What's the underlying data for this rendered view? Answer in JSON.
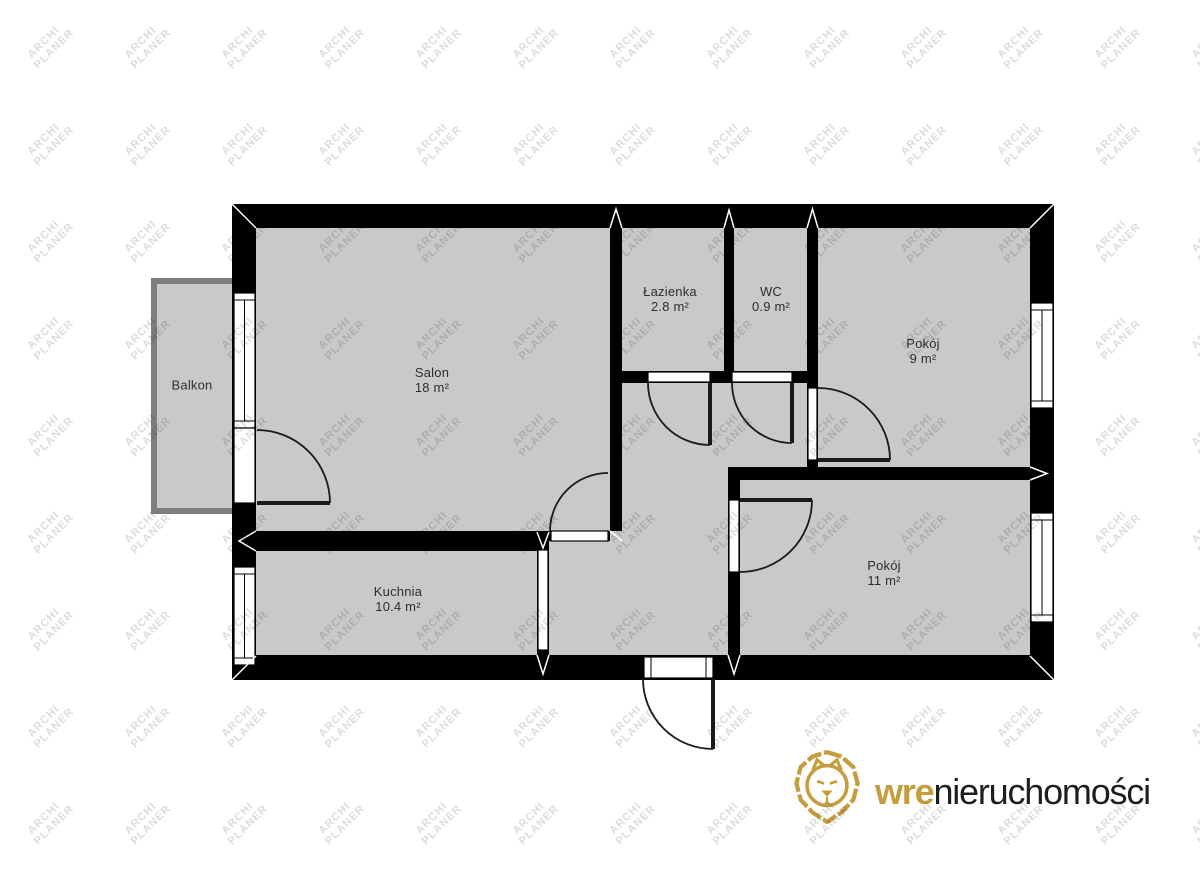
{
  "watermark": {
    "line1": "ARCHI",
    "line2": "PLANER"
  },
  "rooms": {
    "balkon": {
      "name": "Balkon"
    },
    "salon": {
      "name": "Salon",
      "area": "18 m²"
    },
    "kuchnia": {
      "name": "Kuchnia",
      "area": "10.4 m²"
    },
    "lazienka": {
      "name": "Łazienka",
      "area": "2.8 m²"
    },
    "wc": {
      "name": "WC",
      "area": "0.9 m²"
    },
    "pokoj_9": {
      "name": "Pokój",
      "area": "9 m²"
    },
    "pokoj_11": {
      "name": "Pokój",
      "area": "11 m²"
    }
  },
  "logo": {
    "brand_bold": "wre",
    "brand_rest": "nieruchomości"
  },
  "colors": {
    "wall": "#000000",
    "floor": "#c9c9c9",
    "balcony_outline": "#7e7e7e",
    "logo_gold": "#c59d3f",
    "logo_text": "#1e1e1e"
  }
}
